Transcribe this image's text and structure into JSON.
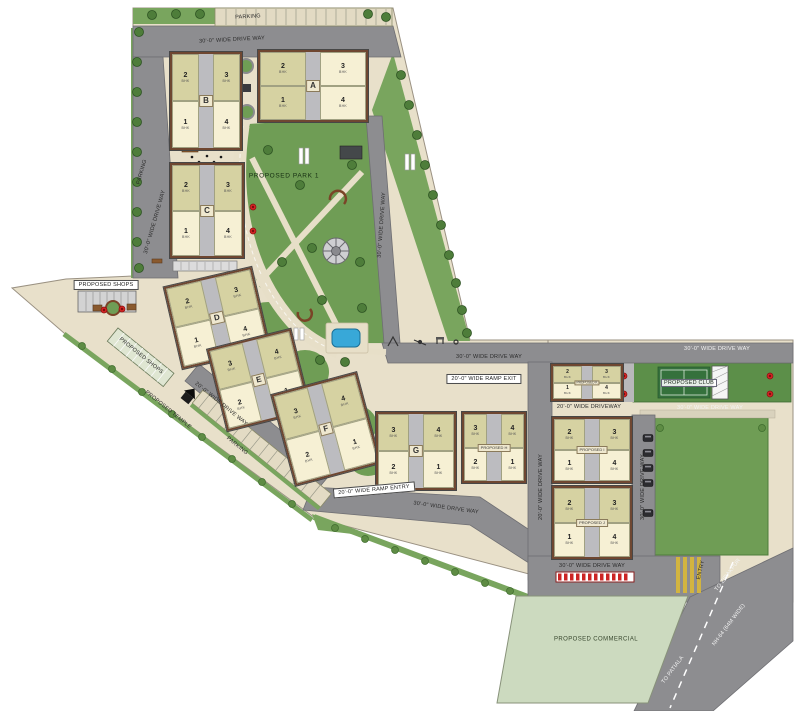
{
  "page": {
    "title": "Residential Township Site Plan"
  },
  "palette": {
    "site_beige": "#e8e0ca",
    "road_gray": "#8d8d90",
    "park_green": "#6f9d55",
    "edge_green": "#79a55e",
    "club_green": "#5c8f49",
    "tennis_green": "#35713c",
    "commercial_green": "#ccdabf",
    "building_border_brown": "#6f4731",
    "unit_olive": "#d6d2a2",
    "unit_cream": "#f6f0d4",
    "pool_blue": "#38a8d8",
    "flower_red": "#d42424",
    "stripe_yellow": "#d2b440"
  },
  "icons": {
    "tree-icon": "green-circle",
    "bush-icon": "small-green-circle",
    "flower-icon": "red-cluster",
    "fountain-icon": "radial-wheel",
    "pool-icon": "blue-rounded-rect",
    "temple-icon": "black-pagoda",
    "car-icon": "dark-rounded-rect",
    "bench-icon": "brown-rect",
    "crosswalk-icon": "yellow-stripes"
  },
  "labels": [
    {
      "name": "parking-label-top",
      "text": "PARKING",
      "x": 248,
      "y": 17,
      "rot": -3,
      "cls": ""
    },
    {
      "name": "drive-way-label-top",
      "text": "30'-0\" WIDE DRIVE WAY",
      "x": 232,
      "y": 40,
      "rot": -3,
      "cls": ""
    },
    {
      "name": "parking-label-left",
      "text": "PARKING",
      "x": 142,
      "y": 172,
      "rot": -74,
      "cls": ""
    },
    {
      "name": "drive-way-label-left",
      "text": "30'-0\" WIDE DRIVE WAY",
      "x": 155,
      "y": 222,
      "rot": -74,
      "cls": ""
    },
    {
      "name": "drive-way-label-park-east",
      "text": "30'-0\" WIDE DRIVE WAY",
      "x": 382,
      "y": 225,
      "rot": -86,
      "cls": ""
    },
    {
      "name": "park-label",
      "text": "PROPOSED PARK 1",
      "x": 284,
      "y": 176,
      "rot": 0,
      "cls": "park"
    },
    {
      "name": "shops-label",
      "text": "PROPOSED SHOPS",
      "x": 106,
      "y": 285,
      "rot": 0,
      "cls": "boxed"
    },
    {
      "name": "shops-label-diagonal",
      "text": "PROPOSED SHOPS",
      "x": 141,
      "y": 356,
      "rot": 39,
      "cls": ""
    },
    {
      "name": "temple-label",
      "text": "PROPOSED TEMPLE",
      "x": 168,
      "y": 410,
      "rot": 39,
      "cls": ""
    },
    {
      "name": "drive-way-label-sw",
      "text": "20'-0\" WIDE DRIVE WAY",
      "x": 221,
      "y": 404,
      "rot": 39,
      "cls": ""
    },
    {
      "name": "parking-label-sw",
      "text": "PARKING",
      "x": 237,
      "y": 446,
      "rot": 39,
      "cls": ""
    },
    {
      "name": "drive-way-label-mid",
      "text": "30'-0\" WIDE DRIVE WAY",
      "x": 489,
      "y": 357,
      "rot": 0,
      "cls": ""
    },
    {
      "name": "ramp-exit-label",
      "text": "20'-0\" WIDE RAMP EXIT",
      "x": 484,
      "y": 379,
      "rot": 0,
      "cls": "boxed"
    },
    {
      "name": "ramp-entry-label",
      "text": "20'-0\" WIDE RAMP ENTRY",
      "x": 374,
      "y": 490,
      "rot": -5,
      "cls": "boxed"
    },
    {
      "name": "drive-way-label-bottom-left",
      "text": "30'-0\" WIDE DRIVE WAY",
      "x": 446,
      "y": 508,
      "rot": 8,
      "cls": ""
    },
    {
      "name": "drive-way-label-club-north",
      "text": "30'-0\" WIDE DRIVE WAY",
      "x": 717,
      "y": 349,
      "rot": 0,
      "cls": "light"
    },
    {
      "name": "club-label",
      "text": "PROPOSED CLUB",
      "x": 689,
      "y": 383,
      "rot": 0,
      "cls": "club"
    },
    {
      "name": "drive-way-label-club-south",
      "text": "30'-0\" WIDE DRIVE WAY",
      "x": 710,
      "y": 408,
      "rot": 0,
      "cls": "light"
    },
    {
      "name": "driveway-label-k",
      "text": "20'-0\" WIDE DRIVEWAY",
      "x": 589,
      "y": 407,
      "rot": 0,
      "cls": ""
    },
    {
      "name": "drive-way-label-west-vertical",
      "text": "20'-0\" WIDE DRIVE WAY",
      "x": 541,
      "y": 487,
      "rot": -90,
      "cls": ""
    },
    {
      "name": "drive-way-label-east-vertical",
      "text": "30'-0\" WIDE DRIVE WAY",
      "x": 643,
      "y": 487,
      "rot": -90,
      "cls": ""
    },
    {
      "name": "drive-way-label-bottom-right",
      "text": "30'-0\" WIDE DRIVE WAY",
      "x": 592,
      "y": 566,
      "rot": 0,
      "cls": ""
    },
    {
      "name": "entry-label",
      "text": "ENTRY",
      "x": 701,
      "y": 570,
      "rot": -77,
      "cls": ""
    },
    {
      "name": "to-zirakpur-label",
      "text": "TO ZIRAKPUR",
      "x": 728,
      "y": 575,
      "rot": -53,
      "cls": "light"
    },
    {
      "name": "nh64-label",
      "text": "NH-64 (64M WIDE)",
      "x": 729,
      "y": 625,
      "rot": -53,
      "cls": "light"
    },
    {
      "name": "to-patiala-label",
      "text": "TO PATIALA",
      "x": 673,
      "y": 670,
      "rot": -53,
      "cls": "light"
    },
    {
      "name": "commercial-label",
      "text": "PROPOSED COMMERCIAL",
      "x": 596,
      "y": 640,
      "rot": 0,
      "cls": "commercial"
    }
  ],
  "buildings": [
    {
      "id": "B",
      "x": 170,
      "y": 52,
      "w": 72,
      "h": 98,
      "rot": 0,
      "center": "B",
      "tones": [
        "o",
        "o",
        "c",
        "c"
      ],
      "units": [
        [
          "2",
          "BHK"
        ],
        [
          "3",
          "BHK"
        ],
        [
          "1",
          "BHK"
        ],
        [
          "4",
          "BHK"
        ]
      ]
    },
    {
      "id": "A",
      "x": 258,
      "y": 50,
      "w": 110,
      "h": 72,
      "rot": 0,
      "center": "A",
      "tones": [
        "o",
        "c",
        "o",
        "c"
      ],
      "units": [
        [
          "2",
          "BHK"
        ],
        [
          "3",
          "BHK"
        ],
        [
          "1",
          "BHK"
        ],
        [
          "4",
          "BHK"
        ]
      ]
    },
    {
      "id": "C",
      "x": 170,
      "y": 163,
      "w": 74,
      "h": 95,
      "rot": 0,
      "center": "C",
      "tones": [
        "o",
        "o",
        "c",
        "c"
      ],
      "units": [
        [
          "2",
          "BHK"
        ],
        [
          "3",
          "BHK"
        ],
        [
          "1",
          "BHK"
        ],
        [
          "4",
          "BHK"
        ]
      ]
    },
    {
      "id": "D",
      "x": 172,
      "y": 276,
      "w": 90,
      "h": 84,
      "rot": -13,
      "center": "D",
      "tones": [
        "o",
        "o",
        "c",
        "c"
      ],
      "units": [
        [
          "2",
          "BHK"
        ],
        [
          "3",
          "BHK"
        ],
        [
          "1",
          "BHK"
        ],
        [
          "4",
          "BHK"
        ]
      ]
    },
    {
      "id": "E",
      "x": 216,
      "y": 338,
      "w": 86,
      "h": 84,
      "rot": -14,
      "center": "E",
      "tones": [
        "o",
        "o",
        "c",
        "c"
      ],
      "units": [
        [
          "3",
          "BHK"
        ],
        [
          "4",
          "BHK"
        ],
        [
          "2",
          "BHK"
        ],
        [
          "1",
          "BHK"
        ]
      ]
    },
    {
      "id": "F",
      "x": 282,
      "y": 382,
      "w": 88,
      "h": 94,
      "rot": -15,
      "center": "F",
      "tones": [
        "o",
        "o",
        "c",
        "c"
      ],
      "units": [
        [
          "3",
          "BHK"
        ],
        [
          "4",
          "BHK"
        ],
        [
          "2",
          "BHK"
        ],
        [
          "1",
          "BHK"
        ]
      ]
    },
    {
      "id": "G",
      "x": 376,
      "y": 412,
      "w": 80,
      "h": 78,
      "rot": 0,
      "center": "G",
      "tones": [
        "o",
        "o",
        "c",
        "c"
      ],
      "units": [
        [
          "3",
          "BHK"
        ],
        [
          "4",
          "BHK"
        ],
        [
          "2",
          "BHK"
        ],
        [
          "1",
          "BHK"
        ]
      ]
    },
    {
      "id": "H",
      "x": 462,
      "y": 412,
      "w": 64,
      "h": 71,
      "rot": 0,
      "center": "PROPOSED H",
      "tones": [
        "o",
        "o",
        "c",
        "c"
      ],
      "units": [
        [
          "3",
          "BHK"
        ],
        [
          "4",
          "BHK"
        ],
        [
          "2",
          "BHK"
        ],
        [
          "1",
          "BHK"
        ]
      ]
    },
    {
      "id": "K",
      "x": 551,
      "y": 364,
      "w": 72,
      "h": 37,
      "rot": 0,
      "small": true,
      "center": "PROPOSED K",
      "tones": [
        "o",
        "o",
        "c",
        "c"
      ],
      "units": [
        [
          "2",
          "BHK"
        ],
        [
          "3",
          "BHK"
        ],
        [
          "1",
          "BHK"
        ],
        [
          "4",
          "BHK"
        ]
      ]
    },
    {
      "id": "I",
      "x": 552,
      "y": 417,
      "w": 80,
      "h": 66,
      "rot": 0,
      "center": "PROPOSED I",
      "tones": [
        "o",
        "o",
        "c",
        "c"
      ],
      "units": [
        [
          "2",
          "BHK"
        ],
        [
          "3",
          "BHK"
        ],
        [
          "1",
          "BHK"
        ],
        [
          "4",
          "BHK"
        ]
      ]
    },
    {
      "id": "J",
      "x": 552,
      "y": 486,
      "w": 80,
      "h": 73,
      "rot": 0,
      "center": "PROPOSED J",
      "tones": [
        "o",
        "o",
        "c",
        "c"
      ],
      "units": [
        [
          "2",
          "BHK"
        ],
        [
          "3",
          "BHK"
        ],
        [
          "1",
          "BHK"
        ],
        [
          "4",
          "BHK"
        ]
      ]
    }
  ]
}
